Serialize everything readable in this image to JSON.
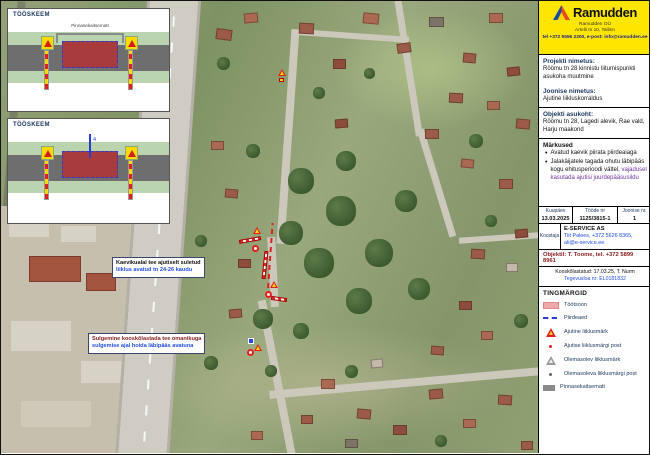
{
  "insets": {
    "scheme1": {
      "title": "TÖÖSKEEM",
      "label": "Pinnasekaitsematt"
    },
    "scheme2": {
      "title": "TÖÖSKEEM",
      "dim": "4"
    }
  },
  "map": {
    "note1": {
      "line1": "Kaevikualal tee ajutiselt suletud",
      "line2": "liiklus avatud tn 24-26 kaudu"
    },
    "note2": {
      "line1": "Sulgemine kooskõlastada tee omanikuga",
      "line2": "sulgemise ajal hoida läbipääs avatuna"
    }
  },
  "panel": {
    "logo": {
      "brand": "Ramudden",
      "line1": "Ramudden OÜ",
      "line2": "Artelli tn 10, Tallinn",
      "line3": "tel +372 5556 2200, e-post: info@ramudden.ee"
    },
    "project": {
      "label": "Projekti nimetus:",
      "value": "Röömu tn 28 kinnistu liitumispunkti asukoha muutmine"
    },
    "drawing": {
      "label": "Joonise nimetus:",
      "value": "Ajutine liikluskorraldus"
    },
    "location": {
      "label": "Objekti asukoht:",
      "value": "Röömu tn 28, Lagedi alevik, Rae vald, Harju maakond"
    },
    "notes": {
      "title": "Märkused",
      "bullets": [
        {
          "text": "Avatud kaevik piirata piirdeaiaga",
          "tail": ""
        },
        {
          "text": "Jalakäijatele tagada ohutu läbipääs kogu ehitusperioodi vältel,",
          "tail": "vajadusel kasutada ajutisi juurdepääsusildu"
        }
      ]
    },
    "meta": {
      "headers": [
        "Kuupäev",
        "Tööde nr",
        "Joonise nr."
      ],
      "values": [
        "13.03.2025",
        "1125/3815-1",
        "1"
      ]
    },
    "author": {
      "label": "Koostaja",
      "company": "E-SERVICE AS",
      "contact1": "Tiit Palees, +372 5626 8365,",
      "contact2": "ali@e-service.ee"
    },
    "site_contact": "Objektil: T. Toome, tel. +372 5899 8961",
    "approval": "Kooskõlastatud: 17.03.25, T. Nurm",
    "permit": "Tegevusloa nr: EL0181832",
    "legend": {
      "title": "TINGMÄRGID",
      "items": [
        {
          "swatch": "workzone",
          "label": "Töötsoon"
        },
        {
          "swatch": "fence",
          "label": "Piirdeaed"
        },
        {
          "swatch": "temp-sign",
          "label": "Ajutine liiklusmärk"
        },
        {
          "swatch": "temp-post",
          "label": "Ajutise liiklusmärgi post"
        },
        {
          "swatch": "exist-sign",
          "label": "Olemasolev liiklusmärk"
        },
        {
          "swatch": "exist-post",
          "label": "Olemasoleva liiklusmärgi post"
        },
        {
          "swatch": "mat",
          "label": "Pinnasekaitsematt"
        }
      ]
    },
    "colors": {
      "brand_yellow": "#FFE600",
      "workzone_pink": "#F0A8A8",
      "temp_sign_red": "#E02020",
      "fence_blue": "#2B3BD6",
      "label_navy": "#17365D"
    }
  }
}
